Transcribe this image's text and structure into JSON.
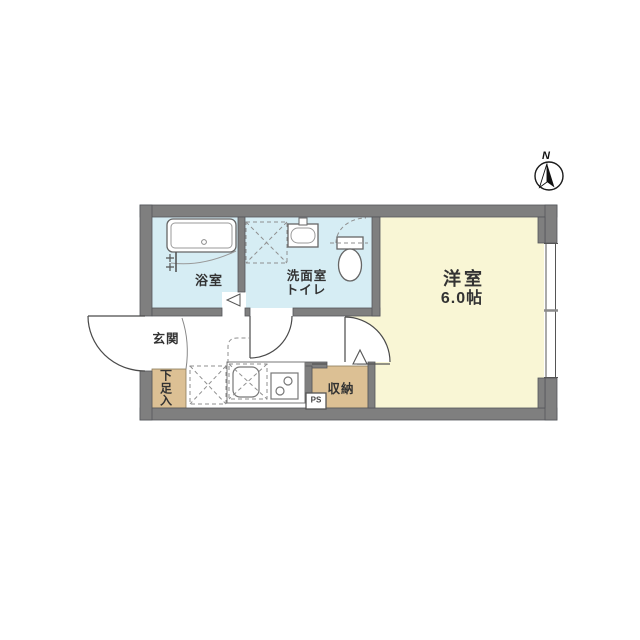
{
  "floorplan": {
    "compass": {
      "label": "N"
    },
    "rooms": {
      "bathroom": {
        "label": "浴室"
      },
      "washroom_toilet": {
        "line1": "洗面室",
        "line2": "トイレ"
      },
      "western_room": {
        "name": "洋室",
        "size": "6.0帖"
      },
      "entrance": {
        "label": "玄関"
      },
      "shoe_cabinet": {
        "label": "下足入"
      },
      "closet": {
        "label": "収納"
      },
      "pipe_space": {
        "label": "PS"
      }
    },
    "colors": {
      "wall": "#7f7f7f",
      "wet_area": "#d6edf4",
      "main_room": "#f9f6d5",
      "storage": "#dcc094",
      "background": "#ffffff"
    }
  }
}
